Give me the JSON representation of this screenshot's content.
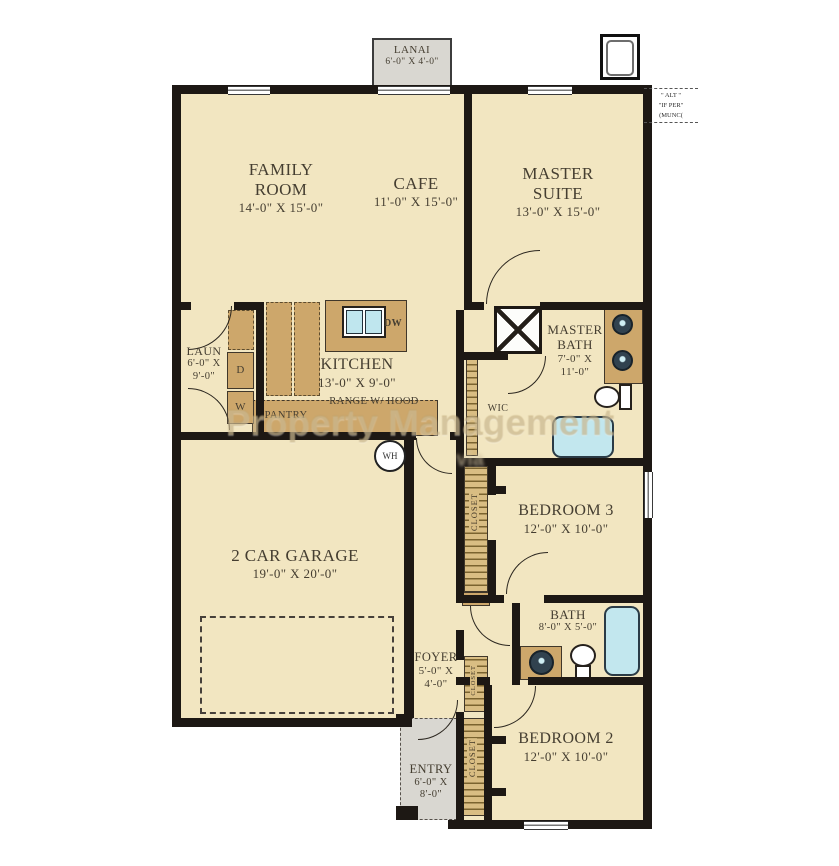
{
  "plan": {
    "lanai": {
      "name": "LANAI",
      "dims": "6'-0\" X 4'-0\""
    },
    "family_room": {
      "name": "FAMILY ROOM",
      "dims": "14'-0\" X 15'-0\""
    },
    "cafe": {
      "name": "CAFE",
      "dims": "11'-0\" X 15'-0\""
    },
    "master_suite": {
      "name": "MASTER SUITE",
      "dims": "13'-0\" X 15'-0\""
    },
    "laundry": {
      "name": "LAUN",
      "dims": "6'-0\" X 9'-0\""
    },
    "kitchen": {
      "name": "KITCHEN",
      "dims": "13'-0\" X 9'-0\""
    },
    "range_hood": "RANGE W/ HOOD",
    "pantry": "PANTRY",
    "dishwasher": "DW",
    "dryer": "D",
    "washer": "W",
    "water_heater": "WH",
    "wic": "WIC",
    "master_bath": {
      "name": "MASTER BATH",
      "dims": "7'-0\" X 11'-0\""
    },
    "bedroom3": {
      "name": "BEDROOM 3",
      "dims": "12'-0\" X 10'-0\""
    },
    "bath2": {
      "name": "BATH",
      "dims": "8'-0\" X 5'-0\""
    },
    "foyer": {
      "name": "FOYER",
      "dims": "5'-0\" X 4'-0\""
    },
    "bedroom2": {
      "name": "BEDROOM 2",
      "dims": "12'-0\" X 10'-0\""
    },
    "entry": {
      "name": "ENTRY",
      "dims": "6'-0\" X 8'-0\""
    },
    "garage": {
      "name": "2 CAR GARAGE",
      "dims": "19'-0\" X 20'-0\""
    },
    "closet": "CLOSET"
  },
  "annotation": {
    "line1": "\" ALT \"",
    "line2": "\"IF PER\"",
    "line3": "(MUNC("
  },
  "watermark": {
    "line1": "Property Management",
    "line2": "via"
  },
  "colors": {
    "floor": "#f2e6c1",
    "wall": "#1d1814",
    "cabinet": "#cda76b",
    "water": "#c2e7ee",
    "porch": "#d9d7d1",
    "watermark": "#b9a270"
  }
}
